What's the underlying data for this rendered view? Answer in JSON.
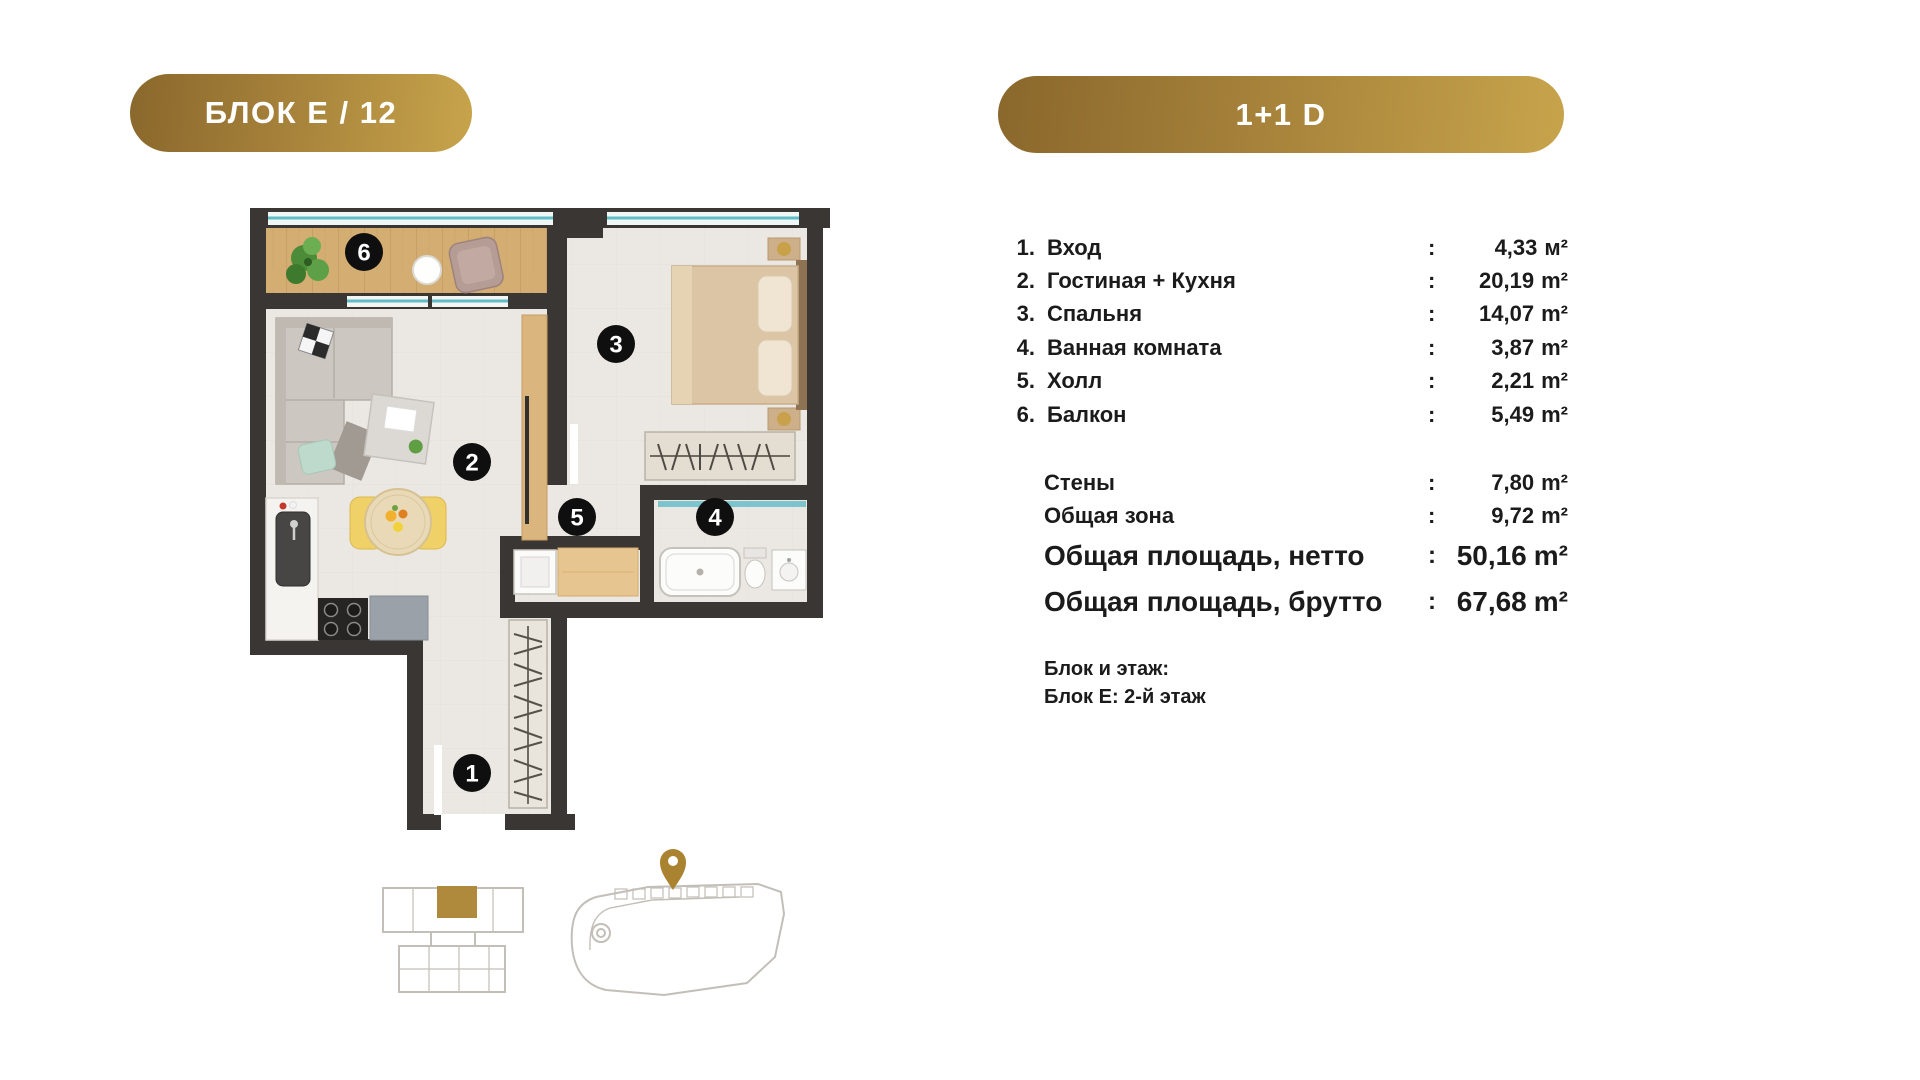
{
  "badges": {
    "left": "БЛОК Е / 12",
    "right": "1+1 D"
  },
  "ui": {
    "colon": ":"
  },
  "rooms": [
    {
      "num": "1.",
      "label": "Вход",
      "value": "4,33",
      "unit": "м²"
    },
    {
      "num": "2.",
      "label": "Гостиная + Кухня",
      "value": "20,19",
      "unit": "m²"
    },
    {
      "num": "3.",
      "label": "Спальня",
      "value": "14,07",
      "unit": "m²"
    },
    {
      "num": "4.",
      "label": "Ванная комната",
      "value": "3,87",
      "unit": "m²"
    },
    {
      "num": "5.",
      "label": "Холл",
      "value": "2,21",
      "unit": "m²"
    },
    {
      "num": "6.",
      "label": "Балкон",
      "value": "5,49",
      "unit": "m²"
    }
  ],
  "summary": [
    {
      "label": "Стены",
      "value": "7,80",
      "unit": "m²"
    },
    {
      "label": "Общая зона",
      "value": "9,72",
      "unit": "m²"
    }
  ],
  "totals": [
    {
      "label": "Общая площадь, нетто",
      "value": "50,16",
      "unit": "m²"
    },
    {
      "label": "Общая площадь, брутто",
      "value": "67,68",
      "unit": "m²"
    }
  ],
  "block_info": {
    "title": "Блок и этаж:",
    "detail": "Блок Е: 2-й этаж"
  },
  "plan_labels": {
    "entry": "1",
    "living": "2",
    "bedroom": "3",
    "bath": "4",
    "hall": "5",
    "balcony": "6"
  },
  "colors": {
    "gold_start": "#8a682c",
    "gold_end": "#c7a44b",
    "wall": "#3a3633",
    "floor": "#ebe8e3",
    "wood": "#d3ac72",
    "window_glass": "#5fbdc7",
    "room_marker": "#0f0f0f",
    "pin": "#a9832f"
  }
}
